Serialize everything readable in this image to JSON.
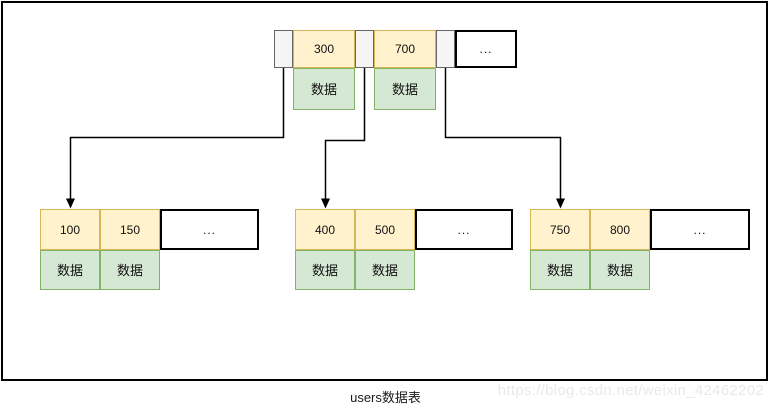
{
  "diagram": {
    "type": "b-plus-tree-index",
    "caption": "users数据表",
    "watermark": "https://blog.csdn.net/weixin_42462202",
    "root": {
      "keys": [
        "300",
        "700"
      ],
      "data_labels": [
        "数据",
        "数据"
      ],
      "ellipsis": "..."
    },
    "leaves": [
      {
        "keys": [
          "100",
          "150"
        ],
        "data_labels": [
          "数据",
          "数据"
        ],
        "ellipsis": "..."
      },
      {
        "keys": [
          "400",
          "500"
        ],
        "data_labels": [
          "数据",
          "数据"
        ],
        "ellipsis": "..."
      },
      {
        "keys": [
          "750",
          "800"
        ],
        "data_labels": [
          "数据",
          "数据"
        ],
        "ellipsis": "..."
      }
    ],
    "colors": {
      "key_fill": "#FFF2CC",
      "key_border": "#D6B656",
      "data_fill": "#D5E8D4",
      "data_border": "#82B366",
      "pointer_fill": "#F5F5F5",
      "pointer_border": "#666666",
      "connector": "#000000",
      "watermark_text": "#E9E9E9"
    }
  }
}
